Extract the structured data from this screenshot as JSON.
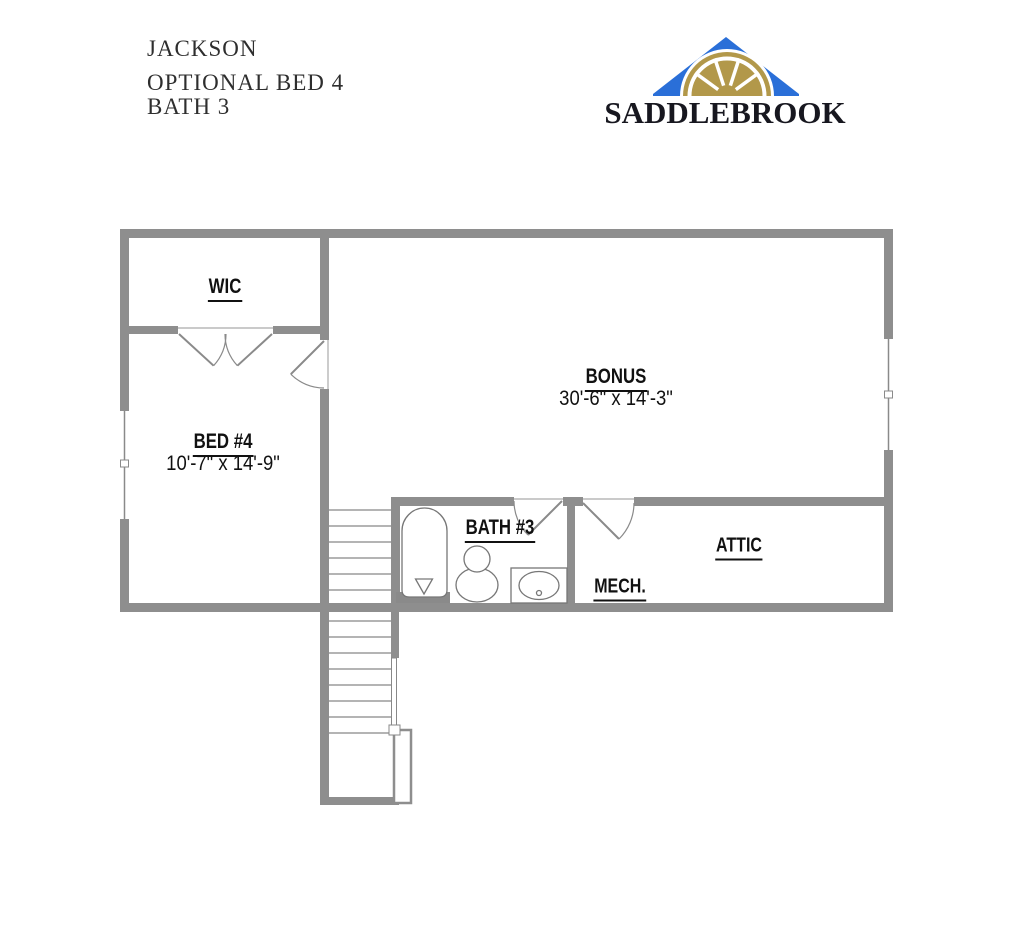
{
  "header": {
    "line1": "JACKSON",
    "line2": "OPTIONAL BED 4",
    "line3": "BATH 3"
  },
  "logo": {
    "brand": "SADDLEBROOK"
  },
  "plan": {
    "rooms": {
      "wic": {
        "label": "WIC"
      },
      "bed4": {
        "label": "BED #4",
        "dims": "10'-7\" x 14'-9\""
      },
      "bonus": {
        "label": "BONUS",
        "dims": "30'-6\" x 14'-3\""
      },
      "bath3": {
        "label": "BATH #3"
      },
      "attic": {
        "label": "ATTIC"
      },
      "mech": {
        "label": "MECH."
      }
    }
  },
  "colors": {
    "wall": "#8e8e8e",
    "roof_blue": "#2a6fd8",
    "fan_gold": "#b2984a"
  }
}
